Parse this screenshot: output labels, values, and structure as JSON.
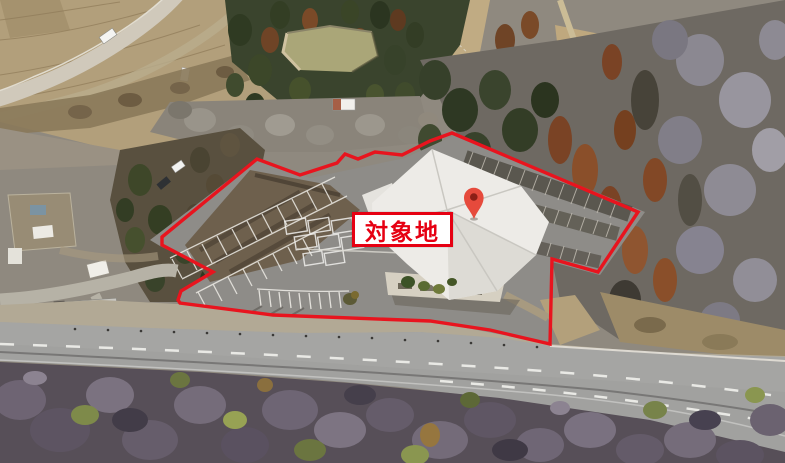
{
  "annotation": {
    "site_label": "対象地",
    "marker_icon": "map-pin",
    "colors": {
      "boundary_stroke": "#e8141e",
      "label_text": "#e60012",
      "label_border": "#e60012",
      "label_background": "#ffffff",
      "pin_fill": "#e64a3c",
      "pin_dot": "#8c1f16"
    }
  }
}
